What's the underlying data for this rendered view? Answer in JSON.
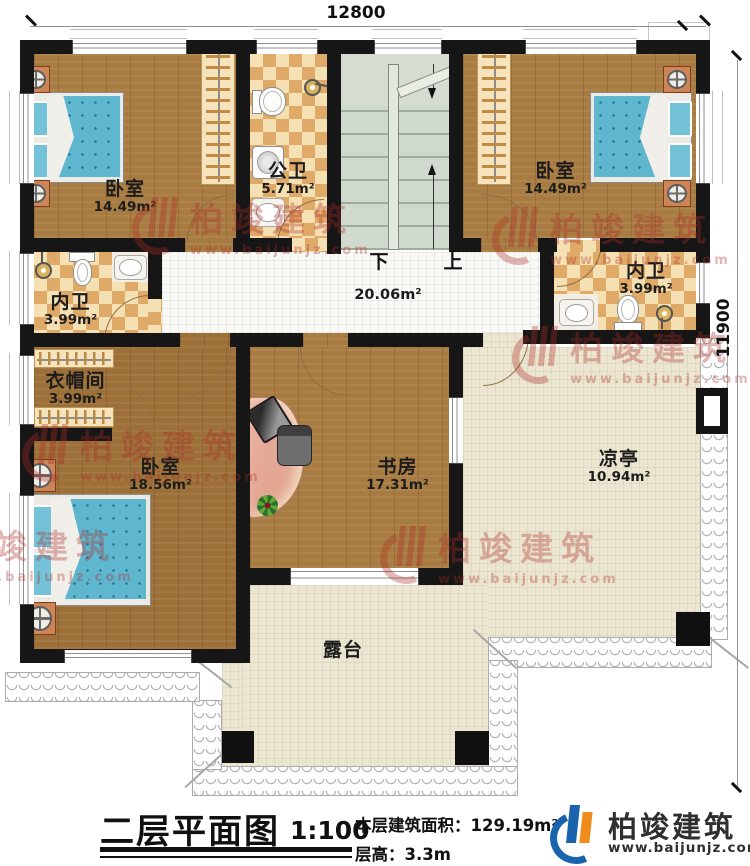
{
  "dimensions": {
    "top": "12800",
    "right": "11900"
  },
  "rooms": {
    "bedroom_tl": {
      "name": "卧室",
      "area": "14.49m²"
    },
    "public_bath": {
      "name": "公卫",
      "area": "5.71m²"
    },
    "bedroom_tr": {
      "name": "卧室",
      "area": "14.49m²"
    },
    "bath_left": {
      "name": "内卫",
      "area": "3.99m²"
    },
    "bath_right": {
      "name": "内卫",
      "area": "3.99m²"
    },
    "cloakroom": {
      "name": "衣帽间",
      "area": "3.99m²"
    },
    "bedroom_bl": {
      "name": "卧室",
      "area": "18.56m²"
    },
    "study": {
      "name": "书房",
      "area": "17.31m²"
    },
    "pavilion": {
      "name": "凉亭",
      "area": "10.94m²"
    },
    "terrace": {
      "name": "露台"
    },
    "hall": {
      "area": "20.06m²"
    }
  },
  "stairs": {
    "down": "下",
    "up": "上"
  },
  "watermark": {
    "brand": "柏竣建筑",
    "url": "www.baijunjz.com"
  },
  "title_block": {
    "title": "二层平面图",
    "scale": "1:100",
    "area_label": "本层建筑面积：",
    "area_value": "129.19m²",
    "height_label": "层高：",
    "height_value": "3.3m"
  },
  "brand": {
    "name": "柏竣建筑",
    "url": "www.baijunjz.com"
  },
  "colors": {
    "wall": "#161616",
    "wood": "#a77b41",
    "tile_light": "#f4e0b2",
    "tile_dark": "#dfa968",
    "stair": "#d0d9cd",
    "terrace_tile": "#ece6d0",
    "bed": "#5fb6cf",
    "watermark": "rgba(172,44,40,0.34)",
    "logo_blue": "#1a63ad",
    "logo_orange": "#f08c1e"
  }
}
